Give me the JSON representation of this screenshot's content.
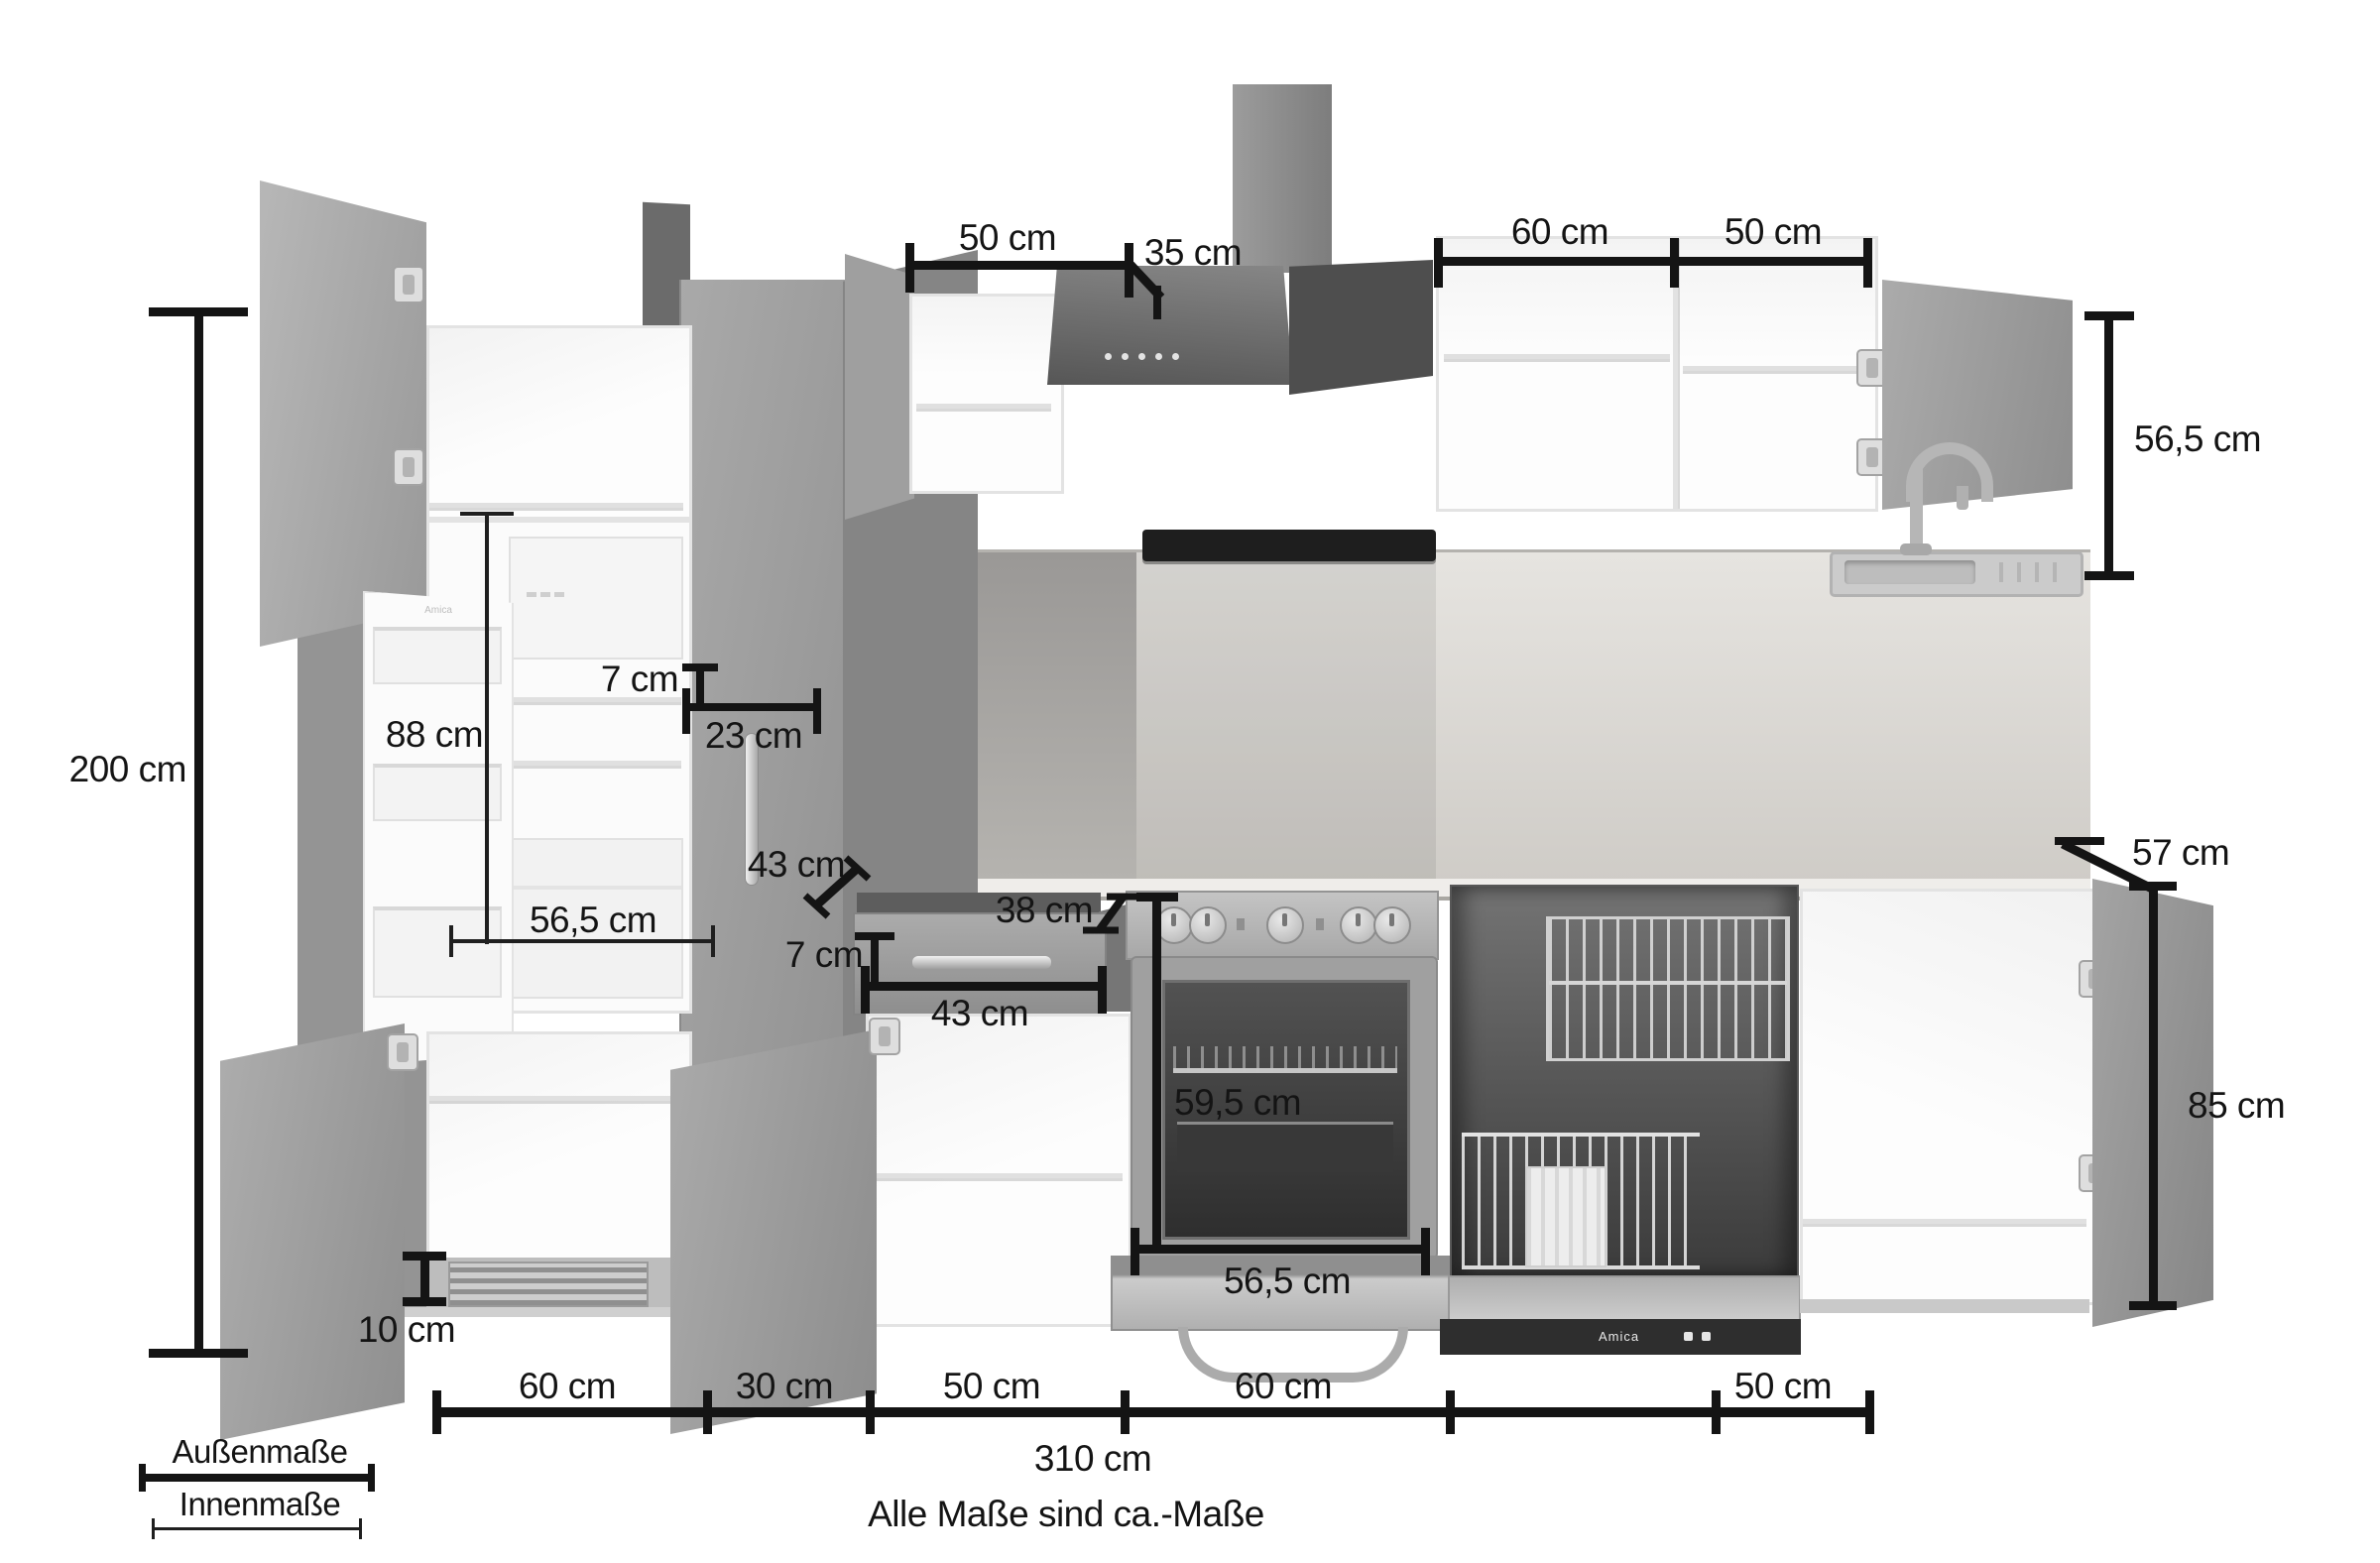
{
  "dimensions": {
    "total_height": "200 cm",
    "fridge_interior_height": "88 cm",
    "top_reveal": "7 cm",
    "pantry_front_width": "23 cm",
    "pantry_depth": "43 cm",
    "fridge_interior_width": "56,5 cm",
    "drawer_front_height": "7 cm",
    "drawer_front_width": "43 cm",
    "drawer_depth": "38 cm",
    "oven_interior_height": "59,5 cm",
    "oven_interior_width": "56,5 cm",
    "wall_cabinet_left_width": "50 cm",
    "hood_depth": "35 cm",
    "wall_cabinet_width_60": "60 cm",
    "wall_cabinet_width_50": "50 cm",
    "wall_cabinet_height": "56,5 cm",
    "worktop_depth": "57 cm",
    "base_height": "85 cm",
    "plinth_vent_height": "10 cm"
  },
  "bottom_scale": {
    "segments": [
      {
        "label": "60 cm"
      },
      {
        "label": "30 cm"
      },
      {
        "label": "50 cm"
      },
      {
        "label": "60 cm"
      },
      {
        "label": "50 cm"
      }
    ],
    "total_width": "310 cm"
  },
  "legend": {
    "outer": "Außenmaße",
    "inner": "Innenmaße"
  },
  "footnote": "Alle Maße sind ca.-Maße",
  "appliance_brand": "Amica",
  "colors": {
    "dimension": "#141414",
    "cabinet_front": "#9b9b9b",
    "cabinet_dark": "#5f5f5f",
    "interior": "#fbfbfb",
    "worktop": "#d8d6d1",
    "background": "#ffffff"
  }
}
